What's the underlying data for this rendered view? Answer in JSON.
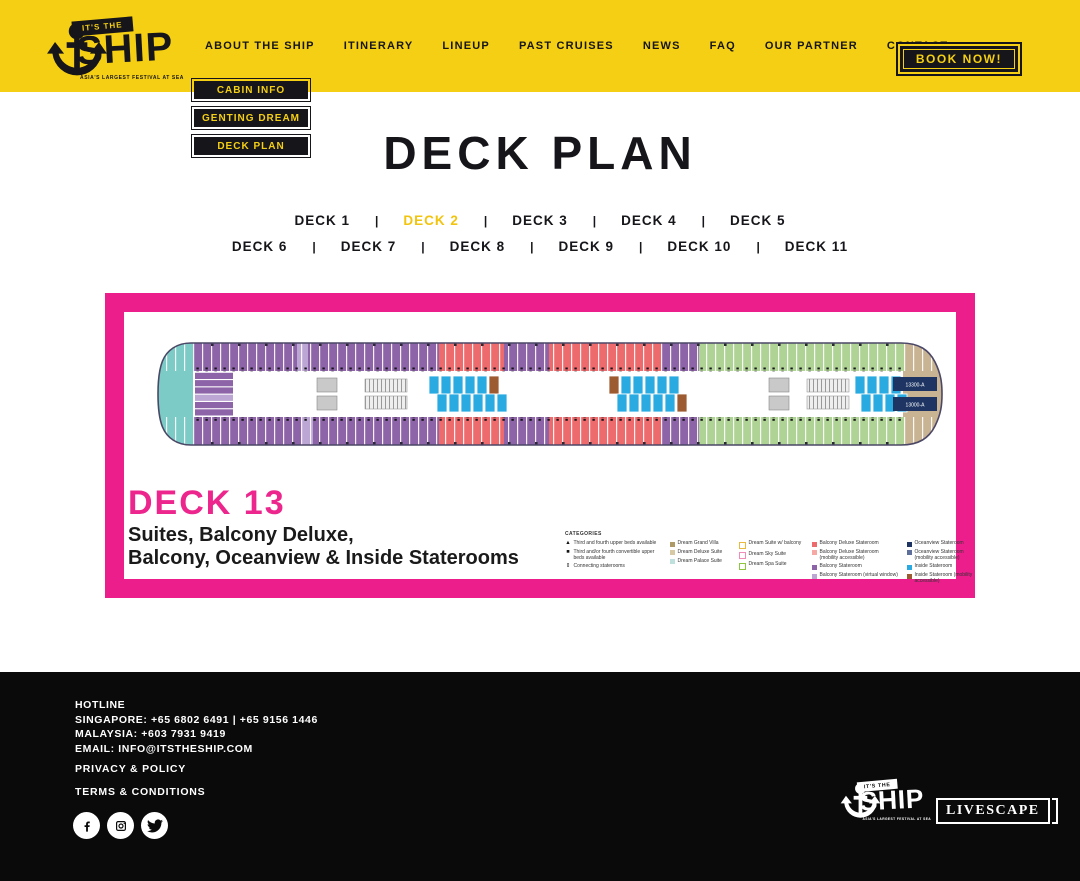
{
  "header": {
    "logo": {
      "top": "IT'S THE",
      "main": "SHIP",
      "tagline": "ASIA'S LARGEST FESTIVAL AT SEA"
    },
    "nav": [
      "ABOUT THE SHIP",
      "ITINERARY",
      "LINEUP",
      "PAST CRUISES",
      "NEWS",
      "FAQ",
      "OUR PARTNER",
      "CONTACT"
    ],
    "book_now": "BOOK NOW!"
  },
  "dropdown": [
    "CABIN INFO",
    "GENTING DREAM",
    "DECK PLAN"
  ],
  "page": {
    "title": "DECK PLAN"
  },
  "deck_nav": {
    "separator": "|",
    "active": "DECK 2",
    "row1": [
      "DECK 1",
      "DECK 2",
      "DECK 3",
      "DECK 4",
      "DECK 5"
    ],
    "row2": [
      "DECK 6",
      "DECK 7",
      "DECK 8",
      "DECK 9",
      "DECK 10",
      "DECK 11"
    ]
  },
  "deck_plan": {
    "heading": "DECK 13",
    "subtitle_line1": "Suites, Balcony Deluxe,",
    "subtitle_line2": "Balcony, Oceanview & Inside Staterooms",
    "suite_labels": [
      "13300-A",
      "13000-A"
    ],
    "legend": {
      "title": "CATEGORIES",
      "columns": [
        {
          "items": [
            {
              "glyph": "▲",
              "label": "Third and fourth upper beds available"
            },
            {
              "glyph": "■",
              "label": "Third and/or fourth convertible upper beds available"
            },
            {
              "glyph": "⇕",
              "label": "Connecting staterooms"
            }
          ]
        },
        {
          "items": [
            {
              "color": "#AD9A66",
              "label": "Dream Grand Villa"
            },
            {
              "color": "#D8C9A5",
              "label": "Dream Deluxe Suite"
            },
            {
              "color": "#BFE0DC",
              "label": "Dream Palace Suite"
            }
          ]
        },
        {
          "items": [
            {
              "color": "#E8B93C",
              "outline": true,
              "label": "Dream Suite w/ balcony"
            },
            {
              "color": "#F08CB7",
              "outline": true,
              "label": "Dream Sky Suite"
            },
            {
              "color": "#8CC63F",
              "outline": true,
              "label": "Dream Spa Suite"
            }
          ]
        },
        {
          "items": [
            {
              "color": "#ED6B6D",
              "label": "Balcony Deluxe Stateroom"
            },
            {
              "color": "#F6A8A4",
              "label": "Balcony Deluxe Stateroom (mobility accessible)"
            },
            {
              "color": "#8D64A8",
              "label": "Balcony Stateroom"
            },
            {
              "color": "#BCA6D3",
              "label": "Balcony Stateroom (virtual window)"
            }
          ]
        },
        {
          "items": [
            {
              "color": "#1E3563",
              "label": "Oceanview Stateroom"
            },
            {
              "color": "#5F6F9B",
              "label": "Oceanview Stateroom (mobility accessible)"
            },
            {
              "color": "#29ABE2",
              "label": "Inside Stateroom"
            },
            {
              "color": "#9C5B30",
              "label": "Inside Stateroom (mobility accessible)"
            }
          ]
        }
      ]
    },
    "ship": {
      "colors": {
        "teal": "#7CCBC6",
        "purple": "#8D64A8",
        "purpleLight": "#BCA6D3",
        "red": "#ED6B6D",
        "green": "#AFD295",
        "tan": "#C8B493",
        "blue": "#29ABE2",
        "brown": "#9C5B30",
        "navy": "#1E3563",
        "gray": "#C9C9C9",
        "outline": "#4B4766"
      },
      "top_segments": [
        [
          "purple",
          36,
          140
        ],
        [
          "purpleLight",
          140,
          151
        ],
        [
          "purple",
          151,
          282
        ],
        [
          "red",
          282,
          347
        ],
        [
          "purple",
          347,
          392
        ],
        [
          "red",
          392,
          505
        ],
        [
          "purple",
          505,
          542
        ],
        [
          "green",
          542,
          748
        ],
        [
          "tan",
          748,
          786
        ]
      ],
      "bottom_segments": [
        [
          "purple",
          36,
          145
        ],
        [
          "purpleLight",
          145,
          156
        ],
        [
          "purple",
          156,
          282
        ],
        [
          "red",
          282,
          347
        ],
        [
          "purple",
          347,
          392
        ],
        [
          "red",
          392,
          505
        ],
        [
          "purple",
          505,
          542
        ],
        [
          "green",
          542,
          748
        ],
        [
          "tan",
          748,
          786
        ]
      ],
      "clusters": [
        {
          "x": 272,
          "y": 38,
          "n": 6,
          "brown": 5
        },
        {
          "x": 280,
          "y": 56,
          "n": 6,
          "brown": -1
        },
        {
          "x": 452,
          "y": 38,
          "n": 6,
          "brown": 0
        },
        {
          "x": 460,
          "y": 56,
          "n": 6,
          "brown": 5
        },
        {
          "x": 698,
          "y": 38,
          "n": 4,
          "brown": -1
        },
        {
          "x": 704,
          "y": 56,
          "n": 4,
          "brown": -1
        }
      ]
    }
  },
  "footer": {
    "hotline_title": "HOTLINE",
    "line1": "SINGAPORE: +65 6802 6491 | +65 9156 1446",
    "line2": "MALAYSIA: +603 7931 9419",
    "line3": "EMAIL: INFO@ITSTHESHIP.COM",
    "link1": "PRIVACY & POLICY",
    "link2": "TERMS & CONDITIONS",
    "partner": "LIVESCAPE"
  }
}
